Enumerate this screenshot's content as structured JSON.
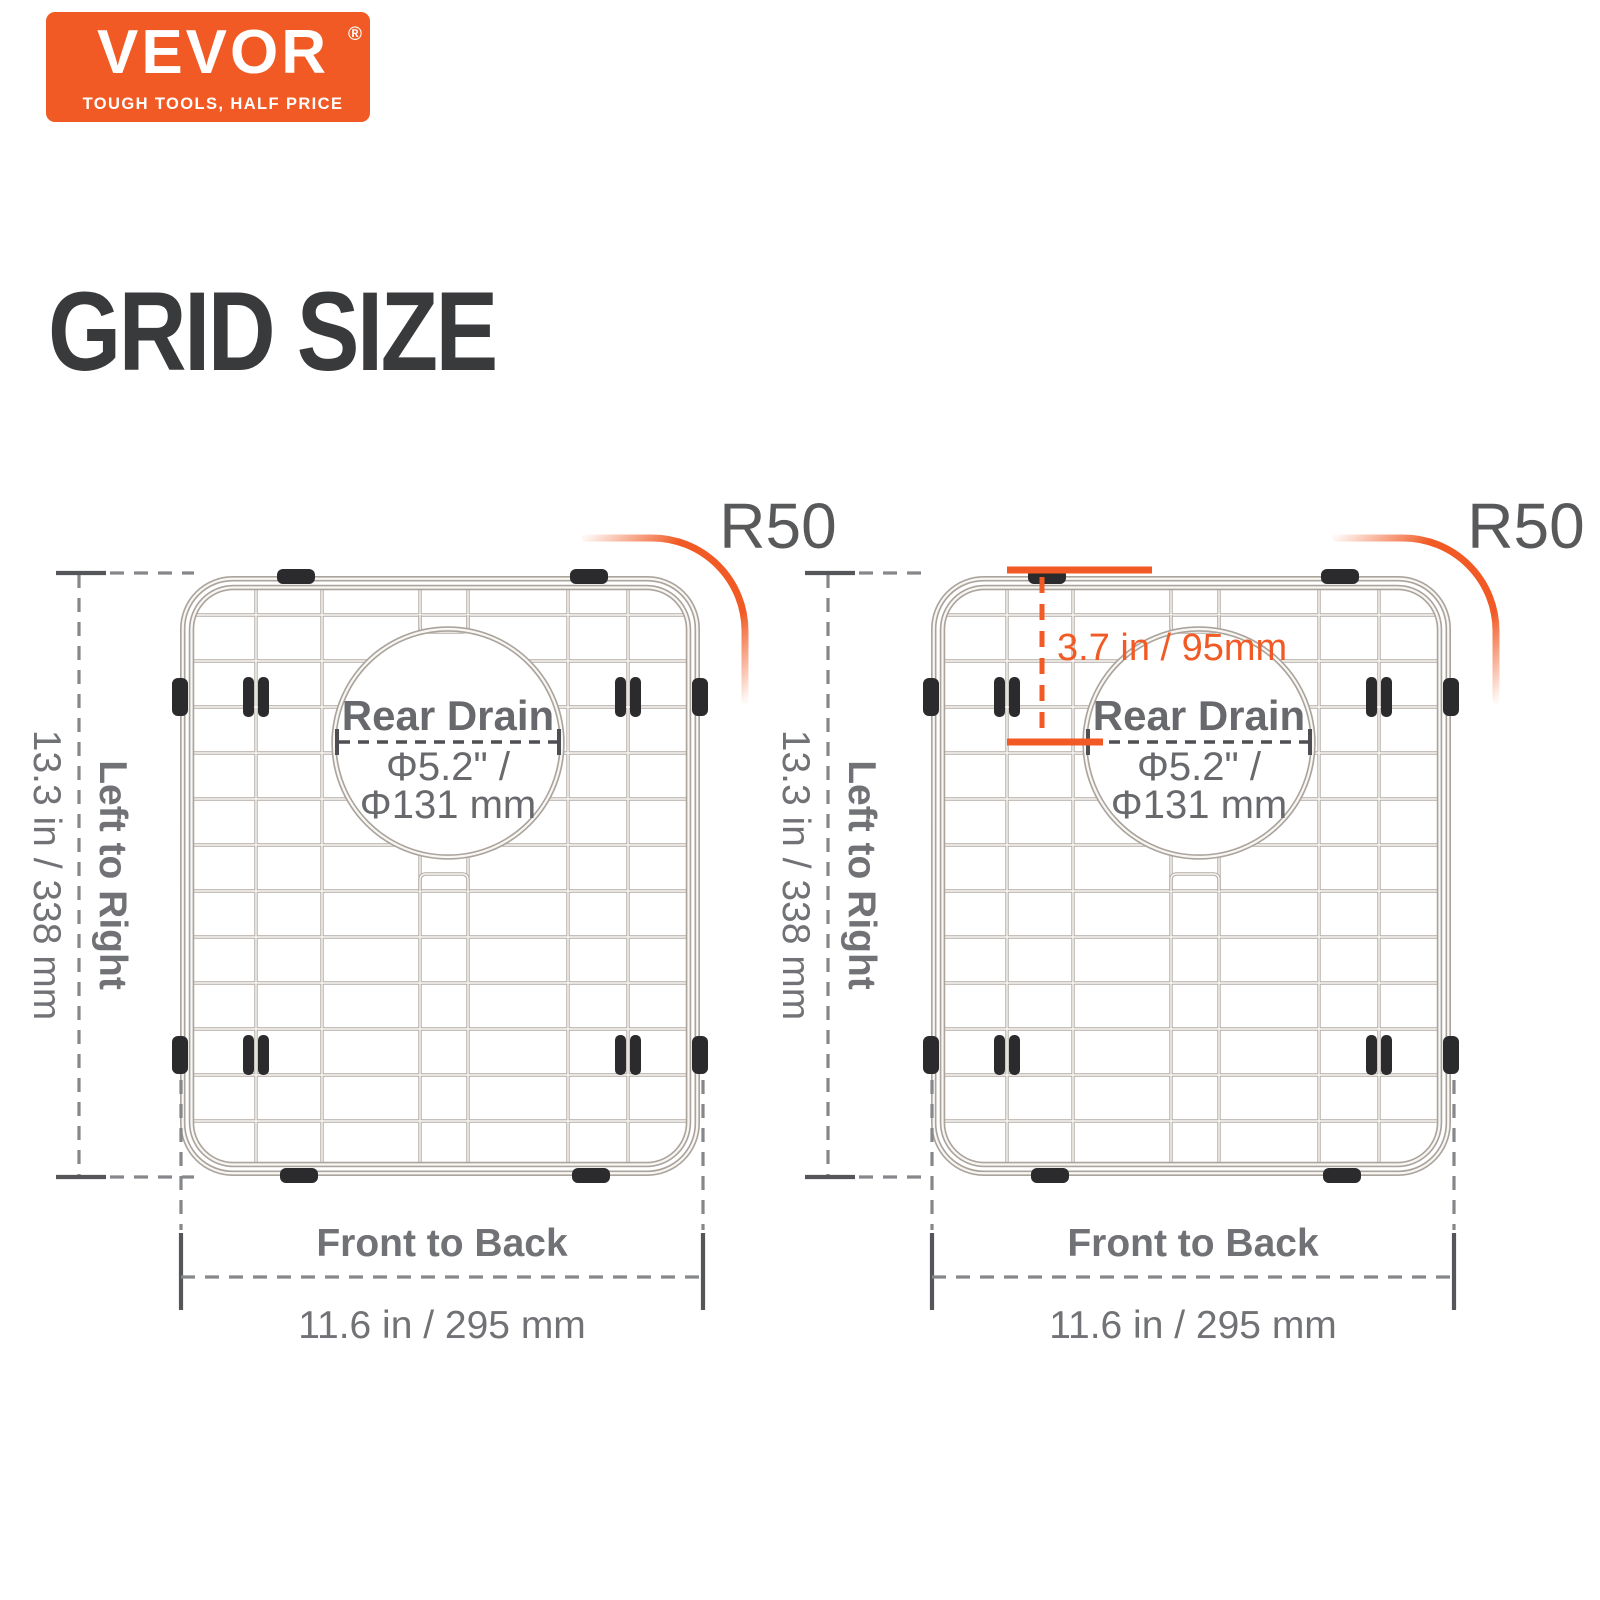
{
  "logo": {
    "brand": "VEVOR",
    "registered_mark": "®",
    "tagline": "TOUGH TOOLS, HALF PRICE",
    "bg_color": "#f15a24",
    "text_color": "#ffffff"
  },
  "heading": {
    "title": "GRID SIZE",
    "color": "#393a3c"
  },
  "colors": {
    "accent_orange": "#f15a24",
    "dim_text_gray": "#717275",
    "dash_gray": "#85878a",
    "tick_gray": "#55565a",
    "drain_text_gray": "#68696c",
    "r50_gray": "#58595b",
    "wire_dark": "#b2aca5",
    "wire_highlight": "#f9f7f4",
    "pad_black": "#2b2b2d"
  },
  "figures": {
    "left": {
      "corner_radius_label": "R50",
      "drain": {
        "title": "Rear Drain",
        "diameter_line1": "Φ5.2\" /",
        "diameter_line2": "Φ131 mm"
      },
      "height_dim": {
        "label": "Left to Right",
        "value": "13.3 in / 338 mm"
      },
      "width_dim": {
        "label": "Front to Back",
        "value": "11.6 in / 295 mm"
      }
    },
    "right": {
      "corner_radius_label": "R50",
      "drain": {
        "title": "Rear Drain",
        "diameter_line1": "Φ5.2\" /",
        "diameter_line2": "Φ131 mm"
      },
      "height_dim": {
        "label": "Left to Right",
        "value": "13.3 in / 338 mm"
      },
      "width_dim": {
        "label": "Front to Back",
        "value": "11.6 in / 295 mm"
      },
      "drain_offset_dim": {
        "value": "3.7 in / 95mm"
      }
    }
  }
}
